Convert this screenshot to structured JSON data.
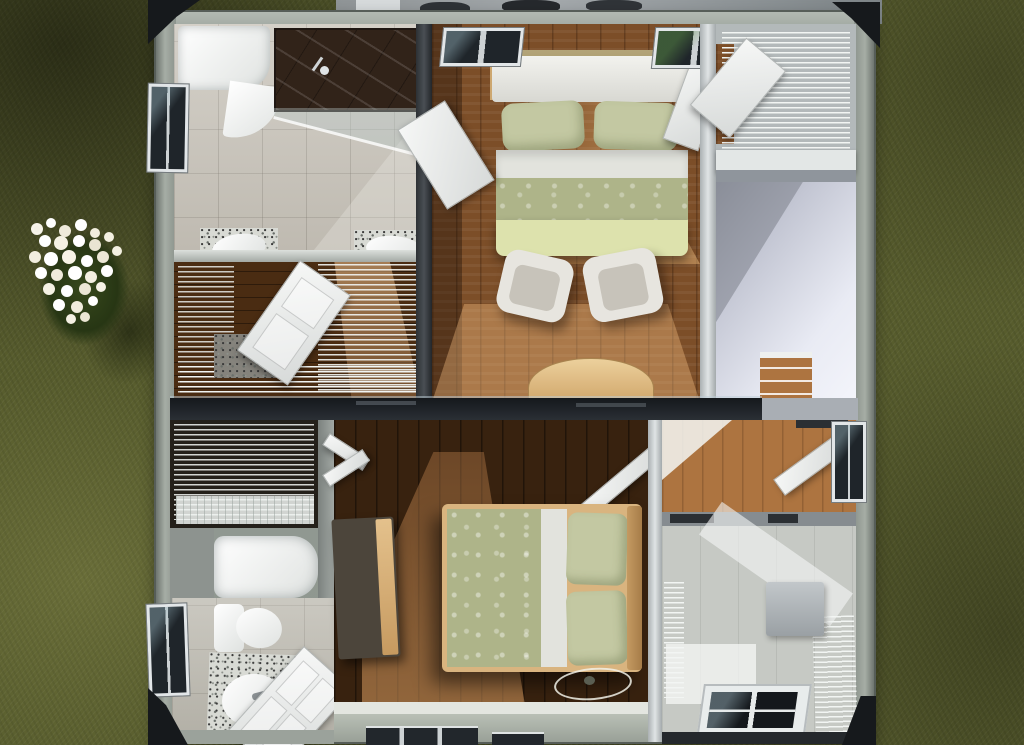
{
  "scene": {
    "type": "3d-architectural-render",
    "view": "top-down-dollhouse-floor-plan",
    "setting": "house interior cutaway on a lawn with a white flowering bush",
    "visible_text": "none"
  },
  "palette": {
    "grass": "#575c2d",
    "flower": "#f4f1e6",
    "roof-edge": "#16191c",
    "house-wall": "#98a098",
    "wood-mid": "#7c4e28",
    "wood-dark": "#38220f",
    "wood-warm": "#ad7440",
    "tile": "#c8c3b9",
    "tile-cool": "#bcb9af",
    "shower": "#312319",
    "glass": "#1f252a",
    "frame": "#e2e6e8",
    "duvet": "#aeb489",
    "blanket": "#dde2ad",
    "pillow": "#c3c8a2",
    "sheet": "#e2e3dd",
    "khaki": "#b3a478",
    "furniture-wood": "#ddbb8a",
    "chair": "#e7e5df",
    "door": "#eef0ef",
    "wire": "#f2f5f3",
    "stair": "#e9ebf4",
    "granite": "#d8dad4",
    "patio": "#979c9f",
    "skylight": "#14181c"
  },
  "rooms": [
    {
      "id": "master-bathroom",
      "features": [
        "bathtub",
        "dark-tile-shower",
        "glass-screen",
        "double-sinks",
        "window"
      ]
    },
    {
      "id": "walk-in-closet",
      "features": [
        "wire-shelving",
        "open-door",
        "sunbeam"
      ]
    },
    {
      "id": "master-bedroom",
      "features": [
        "double-bed",
        "two-armchairs",
        "curved-console",
        "two-windows",
        "open-doors"
      ]
    },
    {
      "id": "linen-closet",
      "features": [
        "wire-shelving"
      ]
    },
    {
      "id": "staircase",
      "features": [
        "stairwell-void",
        "wood-landing"
      ]
    },
    {
      "id": "second-bedroom",
      "features": [
        "double-bed",
        "dresser",
        "bifold-closet-door",
        "ceiling-light"
      ]
    },
    {
      "id": "second-bathroom",
      "features": [
        "bathtub",
        "toilet",
        "granite-vanity",
        "window",
        "open-door"
      ]
    },
    {
      "id": "bonus-room",
      "features": [
        "wire-shelving",
        "cabinet",
        "skylight-window",
        "sloped-walls"
      ]
    }
  ],
  "exterior": [
    "lawn",
    "flowering-bush",
    "bush-shadow",
    "patio-strip",
    "roof-eaves"
  ]
}
